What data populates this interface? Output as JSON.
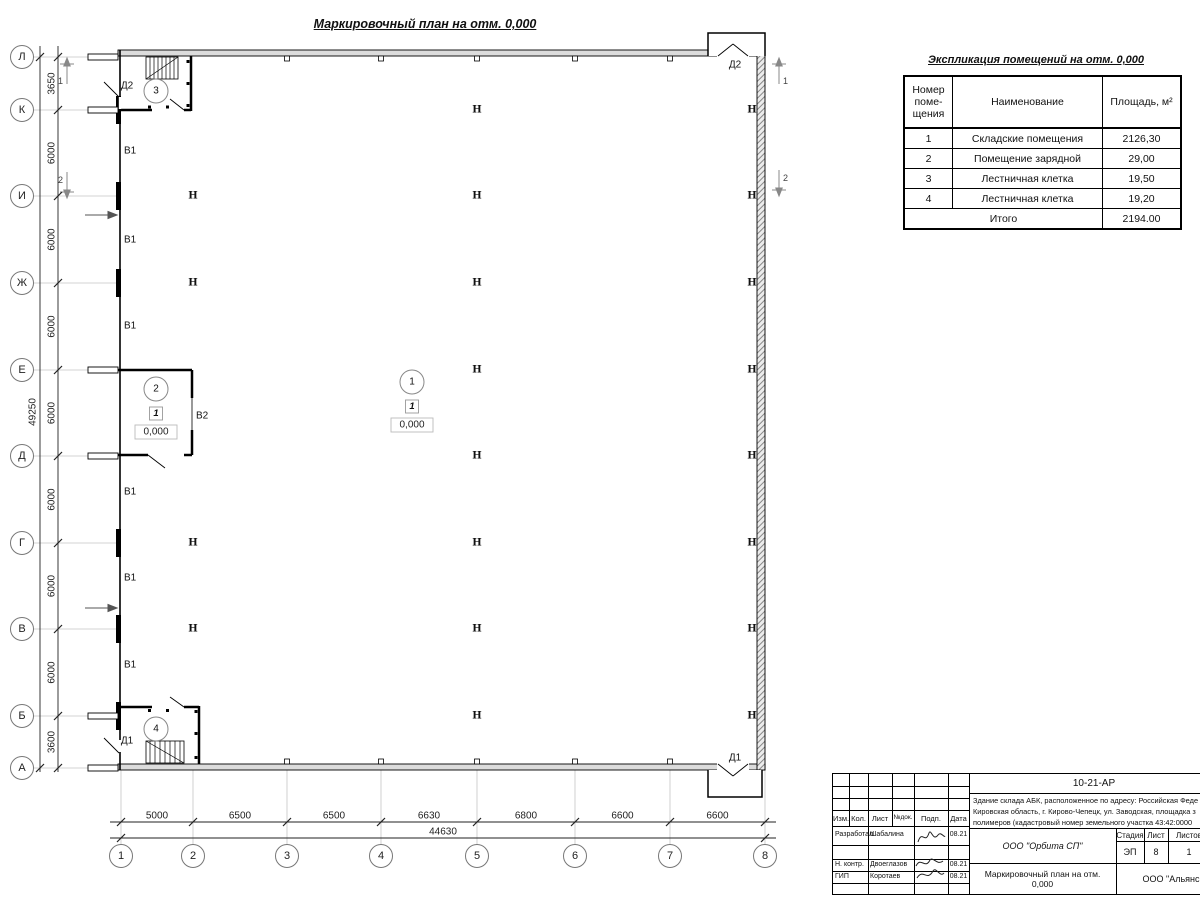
{
  "plan": {
    "title": "Маркировочный план на отм. 0,000",
    "axes_bottom": [
      "1",
      "2",
      "3",
      "4",
      "5",
      "6",
      "7",
      "8"
    ],
    "axes_left": [
      "Л",
      "К",
      "И",
      "Ж",
      "Е",
      "Д",
      "Г",
      "В",
      "Б",
      "А"
    ],
    "dims_bottom": [
      "5000",
      "6500",
      "6500",
      "6630",
      "6800",
      "6600",
      "6600"
    ],
    "total_width": "44630",
    "dims_left": [
      "3650",
      "6000",
      "6000",
      "6000",
      "6000",
      "6000",
      "6000",
      "6000",
      "3600"
    ],
    "total_height": "49250",
    "section1": "1",
    "section2": "2",
    "gate1": "В1",
    "gate2": "В2",
    "door1": "Д1",
    "door2": "Д2",
    "column_symbol": "Н",
    "room1": "1",
    "room2": "2",
    "room3": "3",
    "room4": "4",
    "floor_type": "1",
    "elevation": "0,000"
  },
  "schedule": {
    "title": "Экспликация помещений на отм. 0,000",
    "headers": [
      "Номер поме- щения",
      "Наименование",
      "Площадь, м²"
    ],
    "rows": [
      {
        "num": "1",
        "name": "Складские помещения",
        "area": "2126,30"
      },
      {
        "num": "2",
        "name": "Помещение зарядной",
        "area": "29,00"
      },
      {
        "num": "3",
        "name": "Лестничная клетка",
        "area": "19,50"
      },
      {
        "num": "4",
        "name": "Лестничная клетка",
        "area": "19,20"
      }
    ],
    "total_label": "Итого",
    "total": "2194.00"
  },
  "titleblock": {
    "doc_number": "10-21-АР",
    "description_lines": [
      "Здание склада АБК, расположенное по адресу: Российская Феде",
      "Кировская область, г. Кирово-Чепецк, ул. Заводская, площадка з",
      "полимеров (кадастровый номер земельного участка 43:42:0000"
    ],
    "header_cols": [
      "Изм.",
      "Кол.",
      "Лист",
      "№док.",
      "Подп.",
      "Дата"
    ],
    "roles": [
      {
        "role": "Разработал",
        "name": "Шабалина",
        "date": "08.21"
      },
      {
        "role": "Н. контр.",
        "name": "Двоеглазов",
        "date": "08.21"
      },
      {
        "role": "ГИП",
        "name": "Коротаев",
        "date": "08.21"
      }
    ],
    "org": "ООО \"Орбита СП\"",
    "stage_label": "Стадия",
    "sheet_label": "Лист",
    "sheets_label": "Листов",
    "stage": "ЭП",
    "sheet": "8",
    "sheets": "1",
    "sheet_title_line1": "Маркировочный план на отм.",
    "sheet_title_line2": "0,000",
    "client": "ООО \"Альянс"
  }
}
